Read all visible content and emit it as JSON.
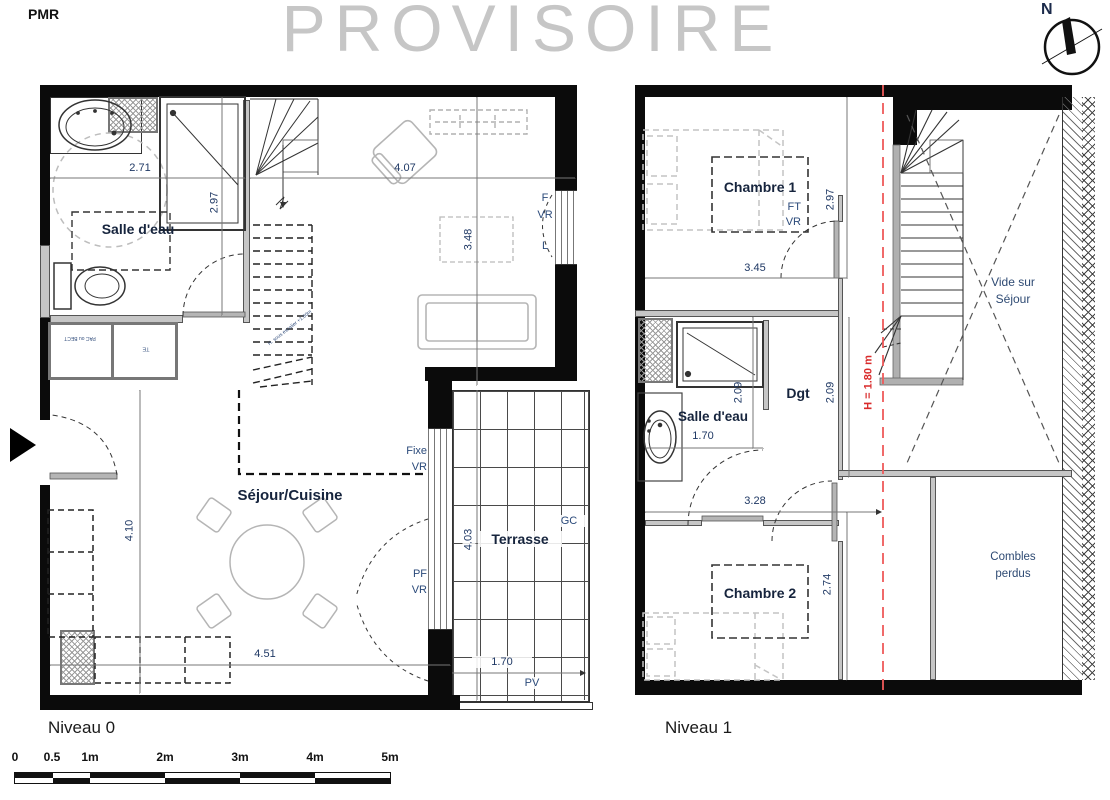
{
  "page": {
    "pmr": "PMR",
    "watermark": "PROVISOIRE",
    "compass_n": "N"
  },
  "level0": {
    "title": "Niveau 0",
    "rooms": {
      "bath": "Salle d'eau",
      "living": "Séjour/Cuisine",
      "terrace": "Terrasse"
    },
    "dims": {
      "bath_w": "2.71",
      "bath_h": "2.97",
      "living_w": "4.07",
      "living_d": "3.48",
      "living_h": "4.10",
      "living_w2": "4.51",
      "terrace_h": "4.03",
      "terrace_w": "1.70"
    },
    "tags": {
      "window_f": "F",
      "window_vr": "VR",
      "window_l": "L",
      "fixe": "Fixe",
      "fixe_vr": "VR",
      "pf": "PF",
      "pf_vr": "VR",
      "gc": "GC",
      "pv": "PV",
      "closet1": "PAC ou BECT",
      "closet2": "TE",
      "stair_note": "H. sous escalier +1.80m"
    }
  },
  "level1": {
    "title": "Niveau 1",
    "rooms": {
      "bedroom1": "Chambre 1",
      "bedroom2": "Chambre 2",
      "bath": "Salle d'eau",
      "hallway": "Dgt",
      "void_line1": "Vide sur",
      "void_line2": "Séjour",
      "attic_line1": "Combles",
      "attic_line2": "perdus"
    },
    "dims": {
      "bedroom1_h": "2.97",
      "bedroom1_w": "3.45",
      "bath_w": "1.70",
      "bath_h": "2.09",
      "hallway_h": "2.09",
      "corridor_w": "3.28",
      "bedroom2_h": "2.74"
    },
    "tags": {
      "ft": "FT",
      "vr": "VR",
      "height_note": "H = 1.80 m"
    }
  },
  "scalebar": {
    "m0": "0",
    "m05": "0.5",
    "m1": "1m",
    "m2": "2m",
    "m3": "3m",
    "m4": "4m",
    "m5": "5m"
  }
}
